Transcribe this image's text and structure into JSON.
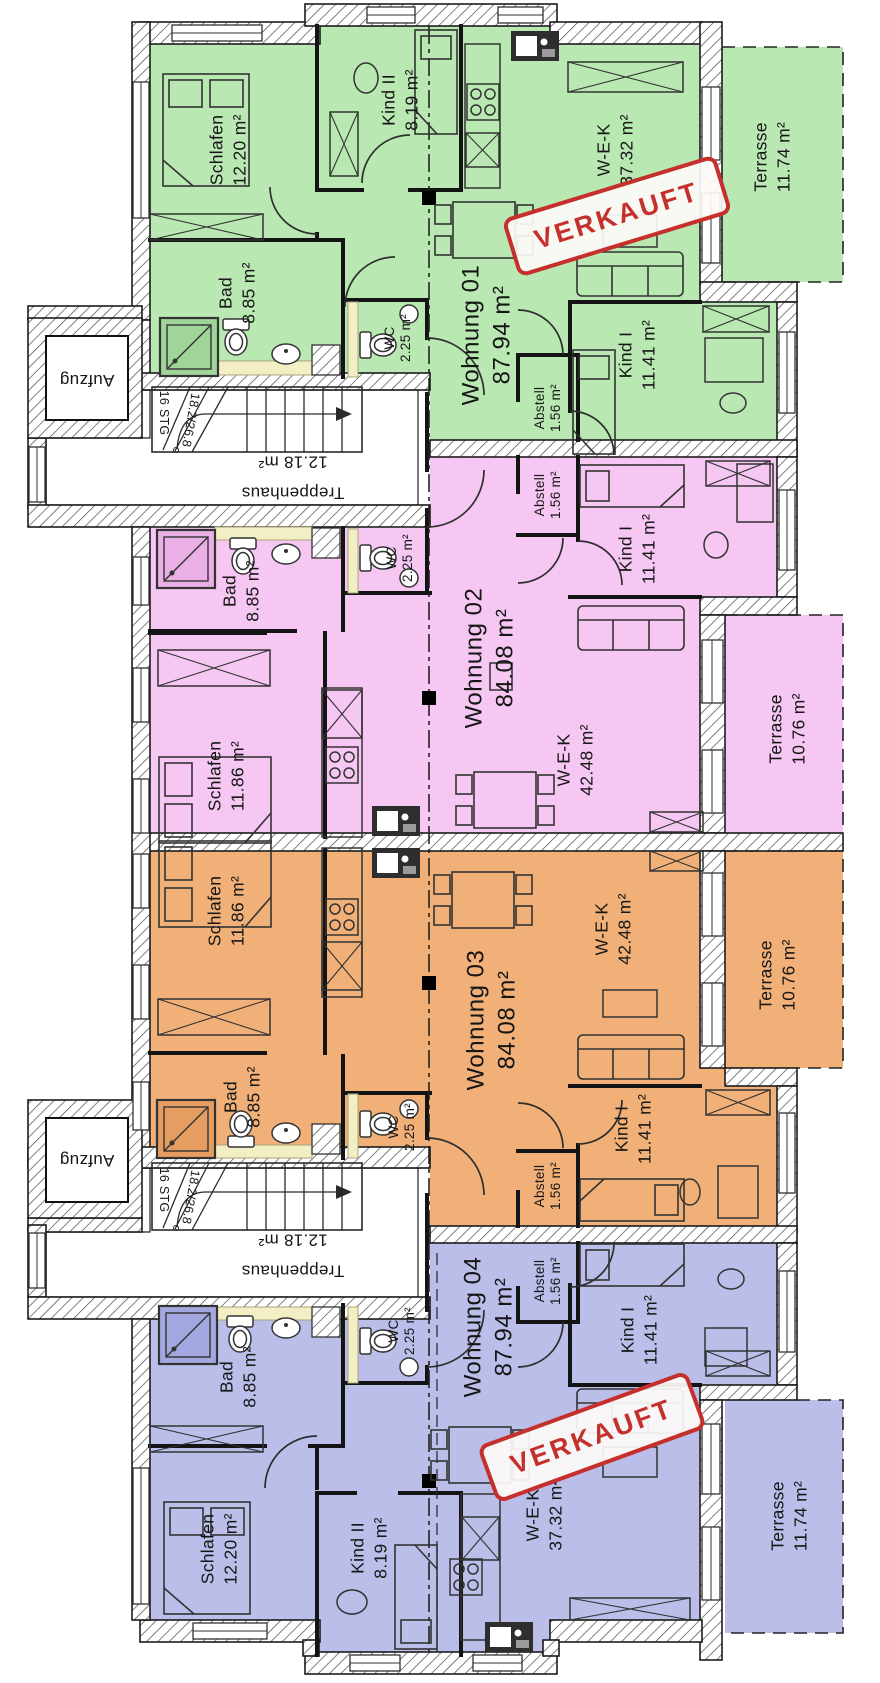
{
  "stamp": {
    "label": "VERKAUFT",
    "color": "#c5302c"
  },
  "stairwell": {
    "room": "Treppenhaus",
    "area": "12.18 m²",
    "steps": "16 STG",
    "rise_run": "18.2/26.8",
    "elevator": "Aufzug"
  },
  "apartments": [
    {
      "name": "Wohnung 01",
      "area": "87.94 m²",
      "color": "#b9e8b2",
      "sold": true,
      "rooms": [
        {
          "name": "Schlafen",
          "area": "12.20 m²"
        },
        {
          "name": "Kind II",
          "area": "8.19 m²"
        },
        {
          "name": "W-E-K",
          "area": "37.32 m²"
        },
        {
          "name": "Bad",
          "area": "8.85 m²"
        },
        {
          "name": "WC",
          "area": "2.25 m²"
        },
        {
          "name": "Kind I",
          "area": "11.41 m²"
        },
        {
          "name": "Abstell",
          "area": "1.56 m²"
        },
        {
          "name": "Terrasse",
          "area": "11.74 m²"
        }
      ]
    },
    {
      "name": "Wohnung 02",
      "area": "84.08 m²",
      "color": "#f5c7f2",
      "sold": false,
      "rooms": [
        {
          "name": "Bad",
          "area": "8.85 m²"
        },
        {
          "name": "WC",
          "area": "2.25 m²"
        },
        {
          "name": "Schlafen",
          "area": "11.86 m²"
        },
        {
          "name": "W-E-K",
          "area": "42.48 m²"
        },
        {
          "name": "Kind I",
          "area": "11.41 m²"
        },
        {
          "name": "Abstell",
          "area": "1.56 m²"
        },
        {
          "name": "Terrasse",
          "area": "10.76 m²"
        }
      ]
    },
    {
      "name": "Wohnung 03",
      "area": "84.08 m²",
      "color": "#f1b077",
      "sold": false,
      "rooms": [
        {
          "name": "Bad",
          "area": "8.85 m²"
        },
        {
          "name": "WC",
          "area": "2.25 m²"
        },
        {
          "name": "Schlafen",
          "area": "11.86 m²"
        },
        {
          "name": "W-E-K",
          "area": "42.48 m²"
        },
        {
          "name": "Kind I",
          "area": "11.41 m²"
        },
        {
          "name": "Abstell",
          "area": "1.56 m²"
        },
        {
          "name": "Terrasse",
          "area": "10.76 m²"
        }
      ]
    },
    {
      "name": "Wohnung 04",
      "area": "87.94 m²",
      "color": "#babee9",
      "sold": true,
      "rooms": [
        {
          "name": "Schlafen",
          "area": "12.20 m²"
        },
        {
          "name": "Kind II",
          "area": "8.19 m²"
        },
        {
          "name": "W-E-K",
          "area": "37.32 m²"
        },
        {
          "name": "Bad",
          "area": "8.85 m²"
        },
        {
          "name": "WC",
          "area": "2.25 m²"
        },
        {
          "name": "Kind I",
          "area": "11.41 m²"
        },
        {
          "name": "Abstell",
          "area": "1.56 m²"
        },
        {
          "name": "Terrasse",
          "area": "11.74 m²"
        }
      ]
    }
  ]
}
